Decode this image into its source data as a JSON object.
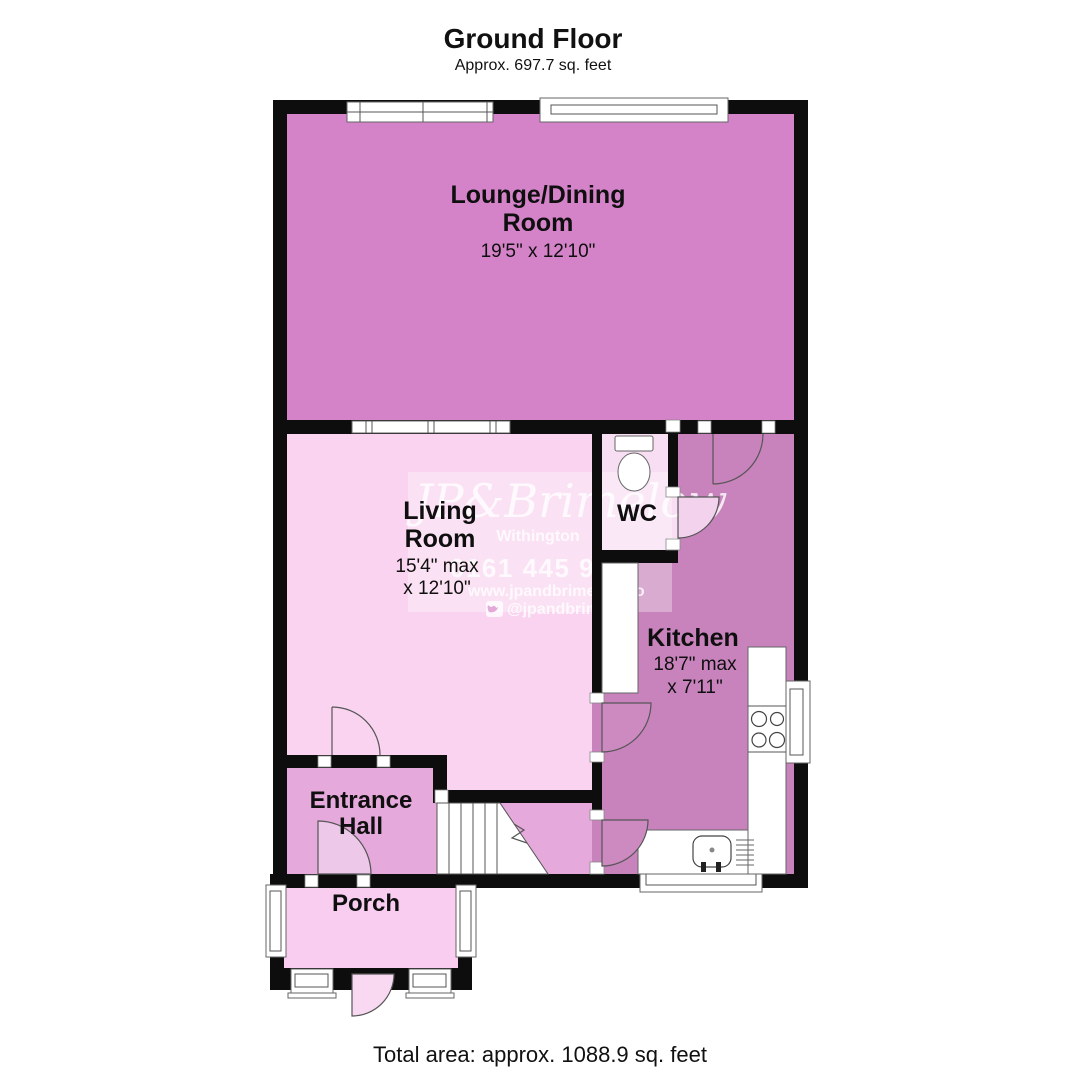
{
  "header": {
    "title": "Ground Floor",
    "subtitle": "Approx. 697.7 sq. feet"
  },
  "footer": {
    "total_area": "Total area: approx. 1088.9 sq. feet"
  },
  "watermark": {
    "brand": "JP&Brimelow",
    "location": "Withington",
    "phone": "0161 445 97",
    "website": "www.jpandbrimelow.co",
    "social": "@jpandbrimelow",
    "social_icon": "twitter-icon"
  },
  "rooms": {
    "lounge": {
      "name": "Lounge/Dining Room",
      "line1": "Lounge/Dining",
      "line2": "Room",
      "dims": "19'5\" x 12'10\""
    },
    "living": {
      "name": "Living Room",
      "line1": "Living",
      "line2": "Room",
      "dims1": "15'4\" max",
      "dims2": "x 12'10\""
    },
    "wc": {
      "name": "WC",
      "label": "WC"
    },
    "kitchen": {
      "name": "Kitchen",
      "label": "Kitchen",
      "dims1": "18'7\" max",
      "dims2": "x 7'11\""
    },
    "hall": {
      "name": "Entrance Hall",
      "line1": "Entrance",
      "line2": "Hall"
    },
    "porch": {
      "name": "Porch",
      "label": "Porch"
    }
  },
  "colors": {
    "lounge": "#d583c9",
    "living": "#f9d3ef",
    "wc": "#f8def3",
    "kitchen": "#c883bc",
    "hall": "#e5a9db",
    "porch": "#f8cdef",
    "wall": "#0d0d0d"
  }
}
